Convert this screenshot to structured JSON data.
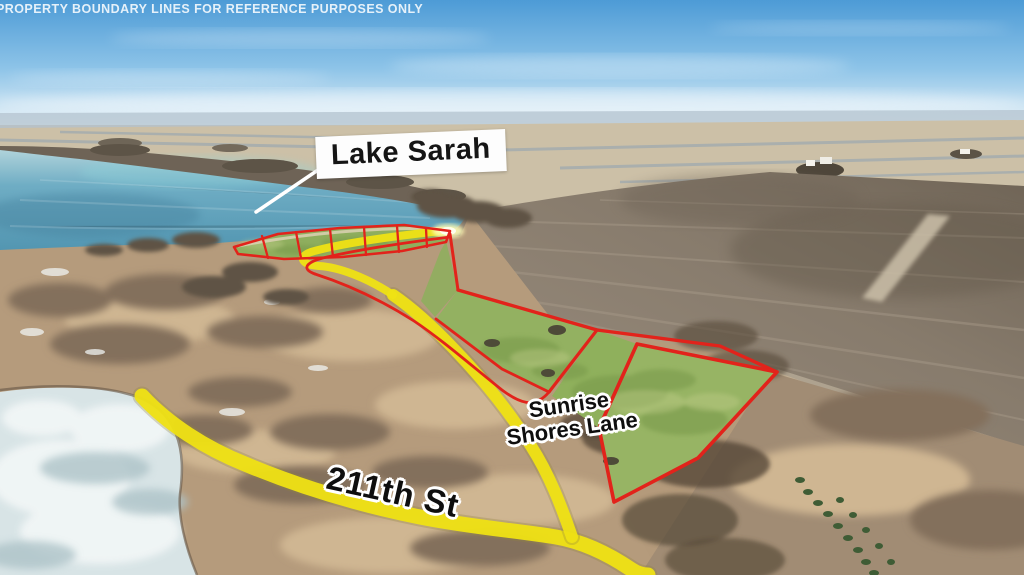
{
  "annotations": {
    "disclaimer": "PROPERTY BOUNDARY LINES FOR REFERENCE PURPOSES ONLY",
    "lake_label": "Lake Sarah",
    "sunrise_road_line1": "Sunrise",
    "sunrise_road_line2": "Shores Lane",
    "street_label": "211th St"
  },
  "palette": {
    "boundary_red": "#e2231b",
    "road_highlight_yellow": "#efe214",
    "lake_water_teal": "#5fa3bd",
    "parcel_grass_green": "#94b161",
    "tilled_field_brown": "#8a7e70",
    "scrub_terrain_tan": "#b49a7b",
    "frozen_pond_ice": "#d8e4e6",
    "sky_blue": "#4d9bd6",
    "label_box_white": "#fdfdfd"
  }
}
